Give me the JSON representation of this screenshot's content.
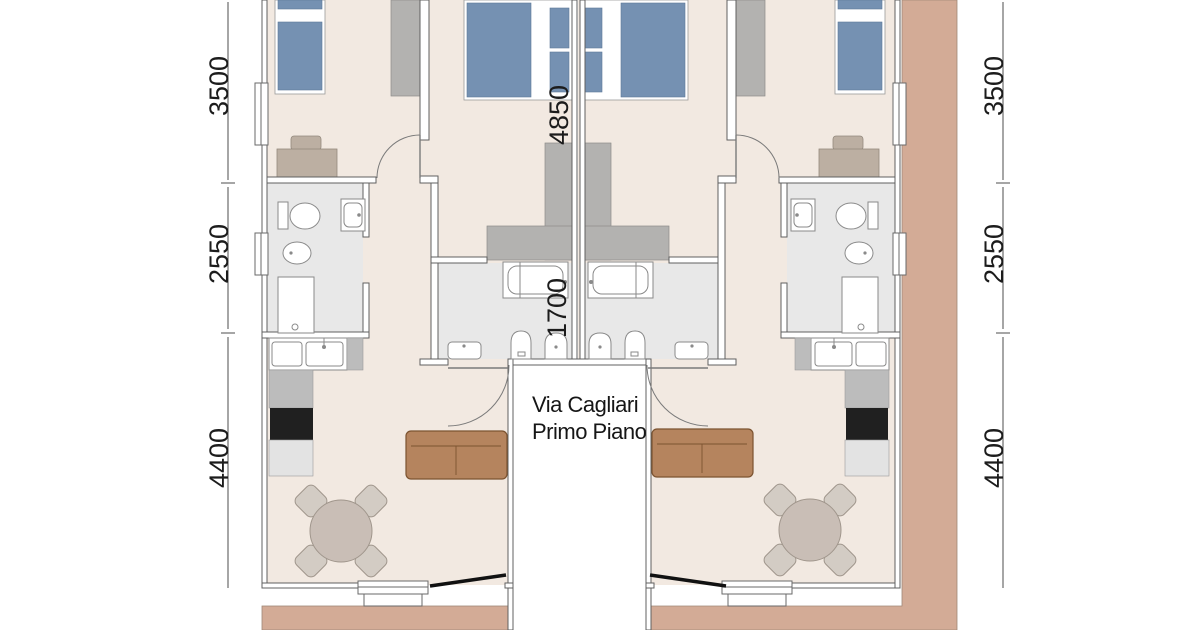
{
  "plan": {
    "title": {
      "line1": "Via Cagliari",
      "line2": "Primo Piano"
    }
  },
  "dims": {
    "left": [
      "3500",
      "2550",
      "4400"
    ],
    "right": [
      "3500",
      "2550",
      "4400"
    ],
    "center": [
      "4850",
      "1700"
    ]
  },
  "symbols": [
    "single-bed",
    "double-bed",
    "pillow",
    "wardrobe",
    "desk",
    "desk-chair",
    "toilet",
    "bidet",
    "sink",
    "shower-tray",
    "bathtub",
    "kitchen-sink",
    "cooktop",
    "counter",
    "sofa",
    "dining-table",
    "dining-chair",
    "door-swing",
    "balcony-door",
    "window",
    "balcony",
    "stairwell"
  ],
  "colors": {
    "floor_beige": "#f2e9e1",
    "bathroom_floor_gray": "#e8e8e8",
    "bed_blue": "#7591b2",
    "furniture_gray": "#b3b2b0",
    "counter_gray": "#bcbcbc",
    "cooktop_black": "#202020",
    "sofa_brown": "#b5845e",
    "table_taupe": "#c9beb6",
    "balcony_tan": "#d3ab96",
    "wall_line": "#606060",
    "dimension_text": "#1c1c1c"
  }
}
